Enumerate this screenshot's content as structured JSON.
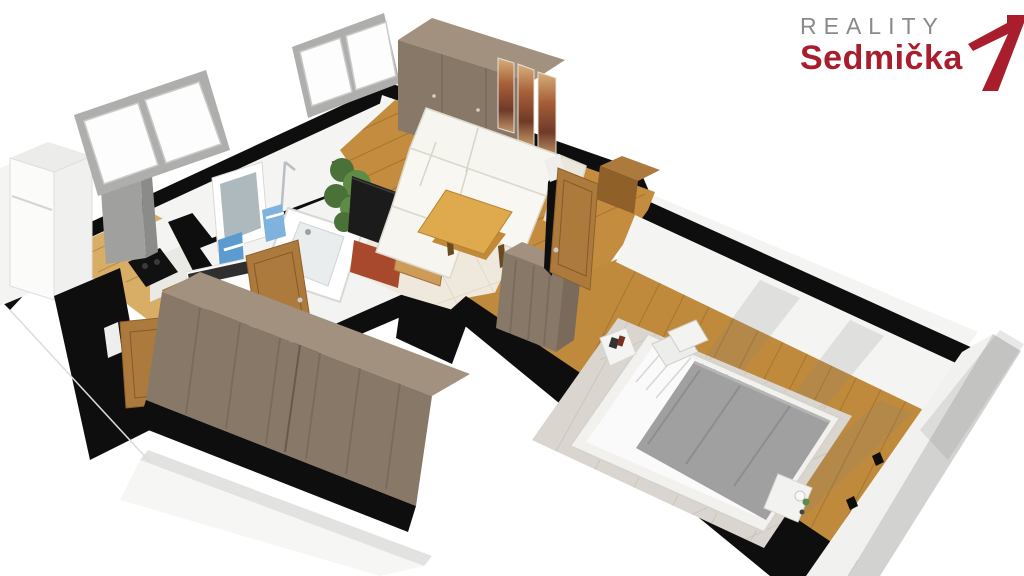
{
  "logo": {
    "brand_top": "REALITY",
    "brand_name": "Sedmička",
    "registered": "®"
  },
  "palette": {
    "ink": "#0e0e0e",
    "wall_face": "#f4f4f2",
    "wall_face_dim": "#e4e4e2",
    "wood_living": "#c48c3e",
    "wood_kitchen": "#d8ad66",
    "wood_bedroom": "#c08a3c",
    "oak_table": "#dfa94e",
    "oak_table_dark": "#c08a38",
    "door_wood": "#ad7a3e",
    "door_wood_dark": "#8f6128",
    "unit_top": "#a2917e",
    "unit_front": "#887868",
    "unit_side": "#796a5c",
    "sofa_white": "#f6f5ef",
    "sofa_shade": "#eae8dc",
    "rug_cream": "#efe9dd",
    "rug_bedroom": "#dad5cf",
    "mattress_white": "#fafafa",
    "blanket_gray": "#a0a0a0",
    "window_frame": "#aeaeac",
    "glass_white": "#fdfdfd",
    "tub_white": "#ffffff",
    "tub_inner": "#e9eded",
    "towel_blue": "#5b9bd0",
    "plant_green": "#4a7238",
    "plant_green_light": "#5e8c47",
    "tv_black": "#1b1b1b",
    "tv_stand_red": "#a8492e",
    "appliance_white": "#fcfcfb",
    "drum_gray": "#6a6e72",
    "logo_red": "#a81e2d",
    "logo_gray": "#8a8a8a",
    "shadow_soft": "rgba(130,130,130,0.18)"
  }
}
